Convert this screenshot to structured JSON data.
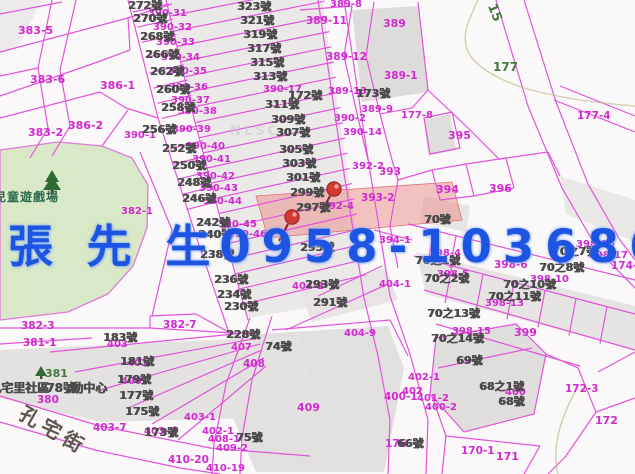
{
  "overlay": {
    "name": "張 先 生",
    "phone": "0958-103680"
  },
  "colors": {
    "overlay_blue": "#1d55e2",
    "parcel_line": "#e254dc",
    "parcel_text": "#d02ad0",
    "house_text": "#4a4a4a",
    "green_text": "#44783c",
    "park_fill": "#d9e8c6",
    "park_text": "#2f6b4f",
    "street_text": "#5f5650",
    "highlight_fill": "#e9807e"
  },
  "park": {
    "label": "兒童遊戲場"
  },
  "street": {
    "name": "孔宅街"
  },
  "community_center": {
    "part1": "孔宅里社區",
    "house_no": "78號",
    "part2": "動中心"
  },
  "watermark": "NLSC",
  "labels": [
    {
      "t": "383-5",
      "x": 18,
      "y": 25,
      "c": "m",
      "s": 11
    },
    {
      "t": "383-6",
      "x": 30,
      "y": 74,
      "c": "m",
      "s": 11
    },
    {
      "t": "386-1",
      "x": 100,
      "y": 80,
      "c": "m",
      "s": 11
    },
    {
      "t": "383-2",
      "x": 28,
      "y": 127,
      "c": "m",
      "s": 11
    },
    {
      "t": "386-2",
      "x": 68,
      "y": 120,
      "c": "m",
      "s": 11
    },
    {
      "t": "390-1",
      "x": 124,
      "y": 131,
      "c": "m"
    },
    {
      "t": "382-1",
      "x": 121,
      "y": 207,
      "c": "m"
    },
    {
      "t": "390-31",
      "x": 148,
      "y": 9,
      "c": "m"
    },
    {
      "t": "390-32",
      "x": 153,
      "y": 23,
      "c": "m"
    },
    {
      "t": "390-33",
      "x": 156,
      "y": 38,
      "c": "m"
    },
    {
      "t": "390-34",
      "x": 161,
      "y": 53,
      "c": "m"
    },
    {
      "t": "390-35",
      "x": 168,
      "y": 67,
      "c": "m"
    },
    {
      "t": "390-36",
      "x": 169,
      "y": 83,
      "c": "m"
    },
    {
      "t": "390-37",
      "x": 171,
      "y": 96,
      "c": "m"
    },
    {
      "t": "390-38",
      "x": 178,
      "y": 107,
      "c": "m"
    },
    {
      "t": "390-39",
      "x": 172,
      "y": 125,
      "c": "m"
    },
    {
      "t": "390-40",
      "x": 186,
      "y": 142,
      "c": "m"
    },
    {
      "t": "390-41",
      "x": 192,
      "y": 155,
      "c": "m"
    },
    {
      "t": "390-42",
      "x": 196,
      "y": 172,
      "c": "m"
    },
    {
      "t": "390-43",
      "x": 199,
      "y": 184,
      "c": "m"
    },
    {
      "t": "390-44",
      "x": 203,
      "y": 197,
      "c": "m"
    },
    {
      "t": "390-45",
      "x": 218,
      "y": 220,
      "c": "m"
    },
    {
      "t": "390-46",
      "x": 228,
      "y": 230,
      "c": "m"
    },
    {
      "t": "390-17",
      "x": 263,
      "y": 85,
      "c": "m"
    },
    {
      "t": "389-8",
      "x": 330,
      "y": 0,
      "c": "m"
    },
    {
      "t": "389-11",
      "x": 306,
      "y": 16,
      "c": "m",
      "s": 10.5
    },
    {
      "t": "389",
      "x": 383,
      "y": 18,
      "c": "m",
      "s": 11
    },
    {
      "t": "389-12",
      "x": 326,
      "y": 52,
      "c": "m",
      "s": 10.5
    },
    {
      "t": "389-1",
      "x": 384,
      "y": 71,
      "c": "m",
      "s": 10.5
    },
    {
      "t": "389-13",
      "x": 328,
      "y": 87,
      "c": "m"
    },
    {
      "t": "389-9",
      "x": 361,
      "y": 105,
      "c": "m"
    },
    {
      "t": "390-2",
      "x": 334,
      "y": 114,
      "c": "m"
    },
    {
      "t": "390-14",
      "x": 343,
      "y": 128,
      "c": "m"
    },
    {
      "t": "177-8",
      "x": 401,
      "y": 111,
      "c": "m"
    },
    {
      "t": "177-4",
      "x": 577,
      "y": 111,
      "c": "m",
      "s": 10.5
    },
    {
      "t": "395",
      "x": 448,
      "y": 130,
      "c": "m",
      "s": 11
    },
    {
      "t": "392-2",
      "x": 352,
      "y": 162,
      "c": "m"
    },
    {
      "t": "393",
      "x": 379,
      "y": 167,
      "c": "m",
      "s": 10.5
    },
    {
      "t": "393-2",
      "x": 361,
      "y": 193,
      "c": "m",
      "s": 10.5
    },
    {
      "t": "392-4",
      "x": 322,
      "y": 202,
      "c": "m"
    },
    {
      "t": "394",
      "x": 436,
      "y": 184,
      "c": "m",
      "s": 11
    },
    {
      "t": "396",
      "x": 489,
      "y": 183,
      "c": "m",
      "s": 11
    },
    {
      "t": "394-1",
      "x": 379,
      "y": 236,
      "c": "m"
    },
    {
      "t": "398-4",
      "x": 429,
      "y": 249,
      "c": "m"
    },
    {
      "t": "398-5",
      "x": 437,
      "y": 270,
      "c": "m"
    },
    {
      "t": "398-6",
      "x": 494,
      "y": 260,
      "c": "m",
      "s": 10.5
    },
    {
      "t": "398-10",
      "x": 530,
      "y": 275,
      "c": "m"
    },
    {
      "t": "398-13",
      "x": 485,
      "y": 299,
      "c": "m"
    },
    {
      "t": "398-15",
      "x": 452,
      "y": 327,
      "c": "m"
    },
    {
      "t": "398-16",
      "x": 576,
      "y": 240,
      "c": "m"
    },
    {
      "t": "398-17",
      "x": 589,
      "y": 251,
      "c": "m"
    },
    {
      "t": "174-2",
      "x": 611,
      "y": 261,
      "c": "m",
      "s": 10.5
    },
    {
      "t": "399",
      "x": 514,
      "y": 327,
      "c": "m",
      "s": 11
    },
    {
      "t": "404-1",
      "x": 379,
      "y": 280,
      "c": "m"
    },
    {
      "t": "404-2",
      "x": 292,
      "y": 282,
      "c": "m"
    },
    {
      "t": "404-9",
      "x": 344,
      "y": 329,
      "c": "m"
    },
    {
      "t": "403",
      "x": 107,
      "y": 340,
      "c": "m"
    },
    {
      "t": "401",
      "x": 127,
      "y": 359,
      "c": "m"
    },
    {
      "t": "400",
      "x": 121,
      "y": 377,
      "c": "m"
    },
    {
      "t": "407",
      "x": 231,
      "y": 343,
      "c": "m"
    },
    {
      "t": "408",
      "x": 243,
      "y": 359,
      "c": "m",
      "s": 10.5
    },
    {
      "t": "409",
      "x": 297,
      "y": 402,
      "c": "m",
      "s": 11
    },
    {
      "t": "402-1",
      "x": 408,
      "y": 373,
      "c": "m"
    },
    {
      "t": "402",
      "x": 402,
      "y": 387,
      "c": "m"
    },
    {
      "t": "400-1",
      "x": 384,
      "y": 392,
      "c": "m",
      "s": 10.5
    },
    {
      "t": "401-2",
      "x": 417,
      "y": 394,
      "c": "m"
    },
    {
      "t": "400-2",
      "x": 425,
      "y": 403,
      "c": "m"
    },
    {
      "t": "403-1",
      "x": 184,
      "y": 413,
      "c": "m"
    },
    {
      "t": "402-1",
      "x": 202,
      "y": 427,
      "c": "m"
    },
    {
      "t": "408-1",
      "x": 208,
      "y": 435,
      "c": "m"
    },
    {
      "t": "409-2",
      "x": 216,
      "y": 444,
      "c": "m"
    },
    {
      "t": "410-20",
      "x": 168,
      "y": 455,
      "c": "m",
      "s": 10.5
    },
    {
      "t": "410-19",
      "x": 206,
      "y": 464,
      "c": "m"
    },
    {
      "t": "403-3",
      "x": 144,
      "y": 427,
      "c": "m"
    },
    {
      "t": "403-7",
      "x": 93,
      "y": 423,
      "c": "m",
      "s": 10.5
    },
    {
      "t": "382-3",
      "x": 21,
      "y": 321,
      "c": "m",
      "s": 10.5
    },
    {
      "t": "381-1",
      "x": 23,
      "y": 338,
      "c": "m",
      "s": 10.5
    },
    {
      "t": "382-7",
      "x": 163,
      "y": 320,
      "c": "m",
      "s": 10.5
    },
    {
      "t": "380",
      "x": 37,
      "y": 395,
      "c": "m",
      "s": 10.5
    },
    {
      "t": "400",
      "x": 505,
      "y": 388,
      "c": "m"
    },
    {
      "t": "176",
      "x": 385,
      "y": 439,
      "c": "m",
      "s": 10.5
    },
    {
      "t": "170-1",
      "x": 461,
      "y": 446,
      "c": "m",
      "s": 10.5
    },
    {
      "t": "171",
      "x": 496,
      "y": 451,
      "c": "m",
      "s": 11
    },
    {
      "t": "172",
      "x": 595,
      "y": 415,
      "c": "m",
      "s": 11
    },
    {
      "t": "172-3",
      "x": 565,
      "y": 384,
      "c": "m",
      "s": 10.5
    },
    {
      "t": "272號",
      "x": 128,
      "y": 0,
      "c": "g"
    },
    {
      "t": "270號",
      "x": 133,
      "y": 13,
      "c": "g"
    },
    {
      "t": "268號",
      "x": 140,
      "y": 31,
      "c": "g"
    },
    {
      "t": "266號",
      "x": 145,
      "y": 49,
      "c": "g"
    },
    {
      "t": "262號",
      "x": 150,
      "y": 66,
      "c": "g"
    },
    {
      "t": "260號",
      "x": 156,
      "y": 84,
      "c": "g"
    },
    {
      "t": "258號",
      "x": 161,
      "y": 102,
      "c": "g"
    },
    {
      "t": "256號",
      "x": 142,
      "y": 124,
      "c": "g"
    },
    {
      "t": "252號",
      "x": 162,
      "y": 143,
      "c": "g"
    },
    {
      "t": "250號",
      "x": 172,
      "y": 160,
      "c": "g"
    },
    {
      "t": "248號",
      "x": 177,
      "y": 177,
      "c": "g"
    },
    {
      "t": "246號",
      "x": 182,
      "y": 193,
      "c": "g"
    },
    {
      "t": "242號",
      "x": 196,
      "y": 217,
      "c": "g"
    },
    {
      "t": "240號",
      "x": 198,
      "y": 229,
      "c": "g"
    },
    {
      "t": "238號",
      "x": 200,
      "y": 249,
      "c": "g"
    },
    {
      "t": "236號",
      "x": 214,
      "y": 274,
      "c": "g"
    },
    {
      "t": "234號",
      "x": 217,
      "y": 289,
      "c": "g"
    },
    {
      "t": "230號",
      "x": 224,
      "y": 301,
      "c": "g"
    },
    {
      "t": "228號",
      "x": 226,
      "y": 329,
      "c": "g"
    },
    {
      "t": "323號",
      "x": 237,
      "y": 1,
      "c": "g"
    },
    {
      "t": "321號",
      "x": 240,
      "y": 15,
      "c": "g"
    },
    {
      "t": "319號",
      "x": 243,
      "y": 29,
      "c": "g"
    },
    {
      "t": "317號",
      "x": 247,
      "y": 43,
      "c": "g"
    },
    {
      "t": "315號",
      "x": 250,
      "y": 57,
      "c": "g"
    },
    {
      "t": "313號",
      "x": 253,
      "y": 71,
      "c": "g"
    },
    {
      "t": "311號",
      "x": 265,
      "y": 99,
      "c": "g"
    },
    {
      "t": "309號",
      "x": 271,
      "y": 114,
      "c": "g"
    },
    {
      "t": "307號",
      "x": 276,
      "y": 127,
      "c": "g"
    },
    {
      "t": "305號",
      "x": 279,
      "y": 144,
      "c": "g"
    },
    {
      "t": "303號",
      "x": 282,
      "y": 158,
      "c": "g"
    },
    {
      "t": "301號",
      "x": 286,
      "y": 172,
      "c": "g"
    },
    {
      "t": "299號",
      "x": 290,
      "y": 187,
      "c": "g"
    },
    {
      "t": "297號",
      "x": 296,
      "y": 202,
      "c": "g"
    },
    {
      "t": "295號",
      "x": 300,
      "y": 242,
      "c": "g"
    },
    {
      "t": "293號",
      "x": 305,
      "y": 279,
      "c": "g"
    },
    {
      "t": "291號",
      "x": 313,
      "y": 297,
      "c": "g"
    },
    {
      "t": "172號",
      "x": 288,
      "y": 90,
      "c": "g"
    },
    {
      "t": "173號",
      "x": 356,
      "y": 88,
      "c": "g"
    },
    {
      "t": "70號",
      "x": 424,
      "y": 214,
      "c": "g"
    },
    {
      "t": "70之1號",
      "x": 415,
      "y": 255,
      "c": "g"
    },
    {
      "t": "70之2號",
      "x": 424,
      "y": 273,
      "c": "g"
    },
    {
      "t": "70之7號",
      "x": 552,
      "y": 246,
      "c": "g"
    },
    {
      "t": "70之8號",
      "x": 539,
      "y": 262,
      "c": "g"
    },
    {
      "t": "70之10號",
      "x": 503,
      "y": 279,
      "c": "g"
    },
    {
      "t": "70之11號",
      "x": 488,
      "y": 291,
      "c": "g"
    },
    {
      "t": "70之13號",
      "x": 427,
      "y": 308,
      "c": "g"
    },
    {
      "t": "70之14號",
      "x": 431,
      "y": 333,
      "c": "g"
    },
    {
      "t": "69號",
      "x": 456,
      "y": 355,
      "c": "g"
    },
    {
      "t": "68之1號",
      "x": 479,
      "y": 381,
      "c": "g"
    },
    {
      "t": "68號",
      "x": 498,
      "y": 396,
      "c": "g"
    },
    {
      "t": "66號",
      "x": 397,
      "y": 438,
      "c": "g"
    },
    {
      "t": "75號",
      "x": 236,
      "y": 432,
      "c": "g"
    },
    {
      "t": "74號",
      "x": 265,
      "y": 341,
      "c": "g"
    },
    {
      "t": "183號",
      "x": 103,
      "y": 332,
      "c": "g"
    },
    {
      "t": "181號",
      "x": 120,
      "y": 356,
      "c": "g"
    },
    {
      "t": "179號",
      "x": 117,
      "y": 374,
      "c": "g"
    },
    {
      "t": "177號",
      "x": 119,
      "y": 390,
      "c": "g"
    },
    {
      "t": "175號",
      "x": 125,
      "y": 406,
      "c": "g"
    },
    {
      "t": "173號",
      "x": 144,
      "y": 427,
      "c": "g"
    },
    {
      "t": "孔宅里社區",
      "x": -11,
      "y": 382,
      "c": "g",
      "s": 12
    },
    {
      "t": "78號",
      "x": 46,
      "y": 382,
      "c": "g",
      "s": 12
    },
    {
      "t": "動中心",
      "x": 71,
      "y": 382,
      "c": "g",
      "s": 12
    },
    {
      "t": "177",
      "x": 493,
      "y": 61,
      "c": "gr",
      "s": 12
    },
    {
      "t": "15",
      "x": 497,
      "y": 2,
      "c": "gr",
      "s": 13,
      "r": 68
    },
    {
      "t": "381",
      "x": 45,
      "y": 368,
      "c": "gr"
    },
    {
      "t": "兒童遊戲場",
      "x": -6,
      "y": 191,
      "c": "pk"
    },
    {
      "t": "孔宅街",
      "x": 26,
      "y": 403,
      "c": "st",
      "r": 30,
      "ls": 5
    },
    {
      "t": "NLSC",
      "x": 230,
      "y": 125,
      "c": "w"
    }
  ]
}
